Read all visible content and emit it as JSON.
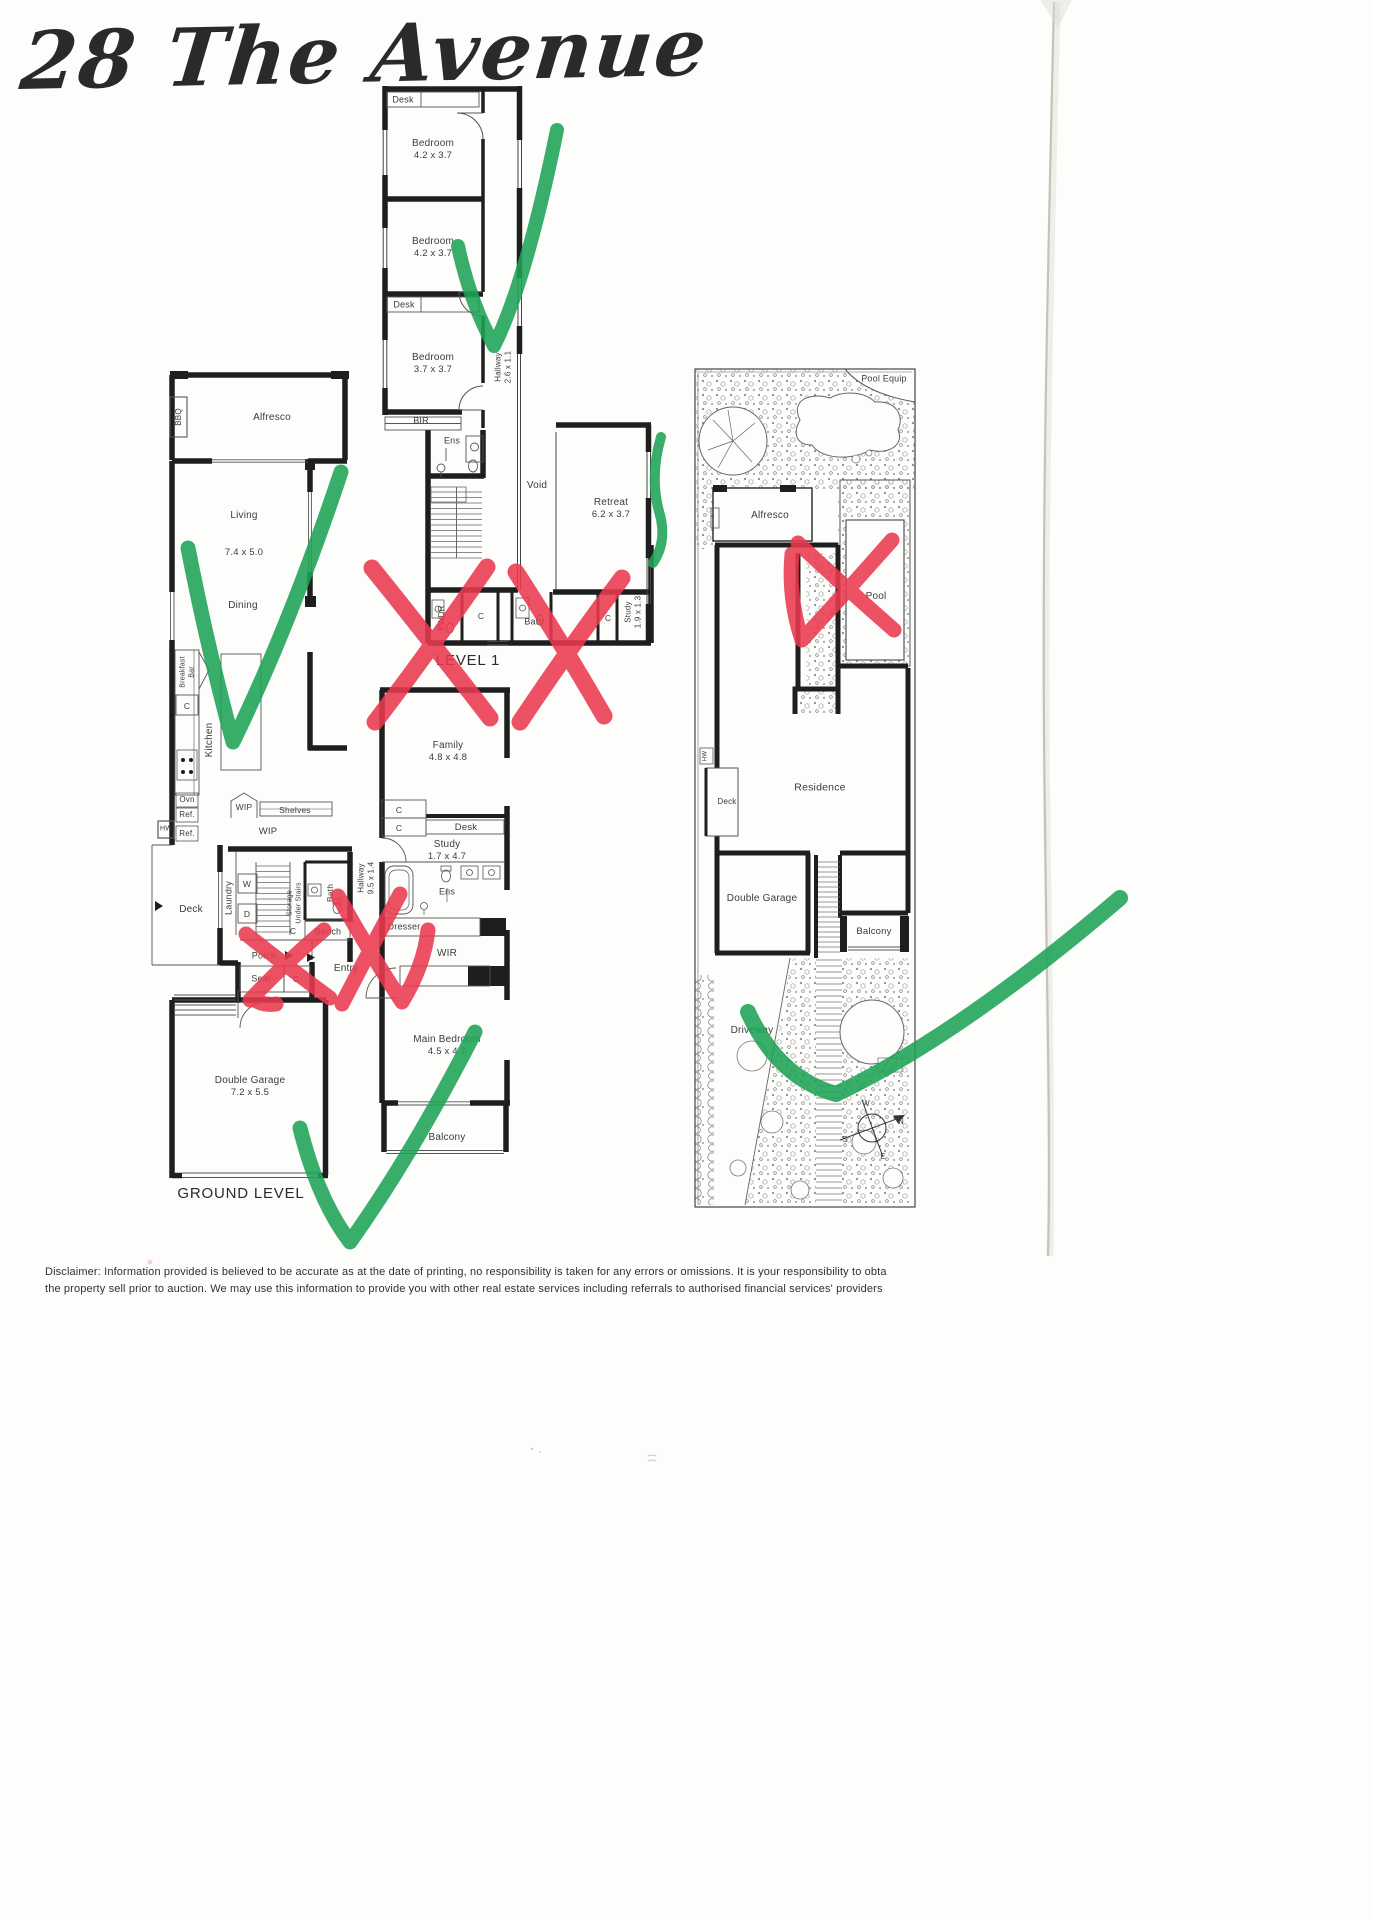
{
  "page": {
    "handwriting": "28 The Avenue",
    "disclaimer_line1": "Disclaimer: Information provided is believed to be accurate as at the date of printing, no responsibility is taken for any errors or omissions. It is your responsibility to obta",
    "disclaimer_line2": "the property sell prior to auction. We may use this information to provide you with other real estate services including referrals to authorised financial services' providers"
  },
  "level1": {
    "label": "LEVEL 1",
    "desk_top": "Desk",
    "bedroom1": {
      "name": "Bedroom",
      "dims": "4.2 x 3.7"
    },
    "bedroom2": {
      "name": "Bedroom",
      "dims": "4.2 x 3.7"
    },
    "desk_mid": "Desk",
    "bedroom3": {
      "name": "Bedroom",
      "dims": "3.7 x 3.7"
    },
    "bir": "BIR",
    "ens": "Ens",
    "hallway": {
      "name": "Hallway",
      "dims": "2.6 x 1.1"
    },
    "void": "Void",
    "retreat": {
      "name": "Retreat",
      "dims": "6.2 x 3.7"
    },
    "pwdr": "PWDR",
    "bath": "Bath",
    "study": {
      "name": "Study",
      "dims": "1.9 x 1.3"
    },
    "c": "C"
  },
  "ground": {
    "label": "GROUND LEVEL",
    "bbq": "BBQ",
    "alfresco": "Alfresco",
    "living": {
      "name": "Living",
      "dims": "7.4 x 5.0"
    },
    "dining": "Dining",
    "breakfast_bar": {
      "line1": "Breakfast",
      "line2": "Bar"
    },
    "kitchen": "Kitchen",
    "ovn": "Ovn",
    "ref": "Ref.",
    "hw": "HW",
    "wip": "WIP",
    "shelves": "Shelves",
    "family": {
      "name": "Family",
      "dims": "4.8 x 4.8"
    },
    "desk": "Desk",
    "study": {
      "name": "Study",
      "dims": "1.7 x 4.7"
    },
    "deck": "Deck",
    "laundry": "Laundry",
    "w": "W",
    "d": "D",
    "storage": {
      "line1": "Storage",
      "line2": "Under Stairs"
    },
    "bath": "Bath",
    "hallway": {
      "name": "Hallway",
      "dims": "9.5 x 1.4"
    },
    "bench": "Bench",
    "porch": "Porch",
    "entry": "Entry",
    "seat": "Seat",
    "dresser": "Dresser",
    "ens": "Ens",
    "wir": "WIR",
    "main_bedroom": {
      "name": "Main Bedroom",
      "dims": "4.5 x 4.7"
    },
    "balcony": "Balcony",
    "double_garage": {
      "name": "Double Garage",
      "dims": "7.2 x 5.5"
    },
    "c": "C"
  },
  "site": {
    "pool_equip": "Pool Equip",
    "alfresco": "Alfresco",
    "pool": "Pool",
    "residence": "Residence",
    "deck": "Deck",
    "hw": "HW",
    "double_garage": "Double Garage",
    "balcony": "Balcony",
    "driveway": "Driveway"
  },
  "compass": {
    "n": "N",
    "s": "S",
    "e": "E",
    "w": "W"
  },
  "annotations": {
    "check_color": "#1ca355",
    "cross_color": "#e9394f",
    "checks": 5,
    "crosses": 5
  }
}
